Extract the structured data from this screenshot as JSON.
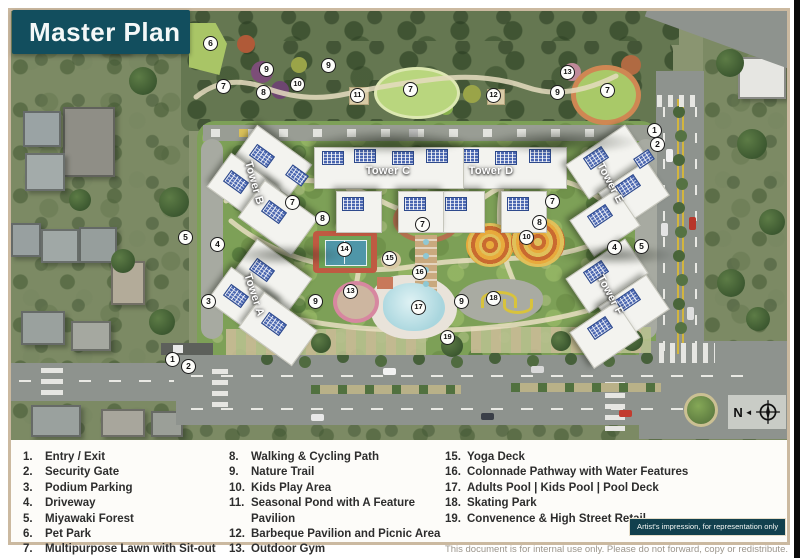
{
  "title": "Master Plan",
  "badge": "Artist's impression, for representation only",
  "footer": "This document is for internal use only. Please do not forward, copy or redistribute.",
  "compass": {
    "label": "N",
    "arrow": "◄"
  },
  "towers": {
    "a": "Tower A",
    "b": "Tower B",
    "c": "Tower C",
    "d": "Tower D",
    "e": "Tower E",
    "f": "Tower F"
  },
  "legend": {
    "col1": [
      {
        "num": "1.",
        "label": "Entry / Exit"
      },
      {
        "num": "2.",
        "label": "Security Gate"
      },
      {
        "num": "3.",
        "label": "Podium Parking"
      },
      {
        "num": "4.",
        "label": "Driveway"
      },
      {
        "num": "5.",
        "label": "Miyawaki Forest"
      },
      {
        "num": "6.",
        "label": "Pet Park"
      },
      {
        "num": "7.",
        "label": "Multipurpose Lawn with Sit-out"
      }
    ],
    "col2": [
      {
        "num": "8.",
        "label": "Walking & Cycling Path"
      },
      {
        "num": "9.",
        "label": "Nature Trail"
      },
      {
        "num": "10.",
        "label": "Kids Play Area"
      },
      {
        "num": "11.",
        "label": "Seasonal Pond with A Feature Pavilion"
      },
      {
        "num": "12.",
        "label": "Barbeque Pavilion and Picnic Area"
      },
      {
        "num": "13.",
        "label": "Outdoor Gym"
      },
      {
        "num": "14.",
        "label": "Multipurpose Sports Court"
      }
    ],
    "col3": [
      {
        "num": "15.",
        "label": "Yoga Deck"
      },
      {
        "num": "16.",
        "label": "Colonnade Pathway with Water Features"
      },
      {
        "num": "17.",
        "label": "Adults Pool | Kids Pool | Pool Deck"
      },
      {
        "num": "18.",
        "label": "Skating Park"
      },
      {
        "num": "19.",
        "label": "Convenence & High Street Retail"
      }
    ]
  },
  "markers": [
    {
      "n": "6",
      "x": 200,
      "y": 33
    },
    {
      "n": "9",
      "x": 256,
      "y": 59
    },
    {
      "n": "7",
      "x": 213,
      "y": 76
    },
    {
      "n": "8",
      "x": 253,
      "y": 82
    },
    {
      "n": "10",
      "x": 287,
      "y": 74
    },
    {
      "n": "9",
      "x": 318,
      "y": 55
    },
    {
      "n": "11",
      "x": 347,
      "y": 85
    },
    {
      "n": "7",
      "x": 400,
      "y": 79
    },
    {
      "n": "12",
      "x": 483,
      "y": 85
    },
    {
      "n": "9",
      "x": 547,
      "y": 82
    },
    {
      "n": "13",
      "x": 557,
      "y": 62
    },
    {
      "n": "7",
      "x": 597,
      "y": 80
    },
    {
      "n": "1",
      "x": 644,
      "y": 120
    },
    {
      "n": "2",
      "x": 647,
      "y": 134
    },
    {
      "n": "5",
      "x": 175,
      "y": 227
    },
    {
      "n": "4",
      "x": 207,
      "y": 234
    },
    {
      "n": "7",
      "x": 282,
      "y": 192
    },
    {
      "n": "8",
      "x": 312,
      "y": 208
    },
    {
      "n": "14",
      "x": 334,
      "y": 239
    },
    {
      "n": "7",
      "x": 412,
      "y": 214
    },
    {
      "n": "15",
      "x": 379,
      "y": 248
    },
    {
      "n": "16",
      "x": 409,
      "y": 262
    },
    {
      "n": "7",
      "x": 542,
      "y": 191
    },
    {
      "n": "8",
      "x": 529,
      "y": 212
    },
    {
      "n": "10",
      "x": 516,
      "y": 227
    },
    {
      "n": "4",
      "x": 604,
      "y": 237
    },
    {
      "n": "5",
      "x": 631,
      "y": 236
    },
    {
      "n": "3",
      "x": 198,
      "y": 291
    },
    {
      "n": "13",
      "x": 340,
      "y": 281
    },
    {
      "n": "9",
      "x": 305,
      "y": 291
    },
    {
      "n": "17",
      "x": 408,
      "y": 297
    },
    {
      "n": "18",
      "x": 483,
      "y": 288
    },
    {
      "n": "9",
      "x": 451,
      "y": 291
    },
    {
      "n": "19",
      "x": 437,
      "y": 327
    },
    {
      "n": "1",
      "x": 162,
      "y": 349
    },
    {
      "n": "2",
      "x": 178,
      "y": 356
    }
  ],
  "colors": {
    "teal": "#124e5e",
    "frame_tan": "#cbb9a0",
    "marker_bg": "#fdfdfa"
  }
}
